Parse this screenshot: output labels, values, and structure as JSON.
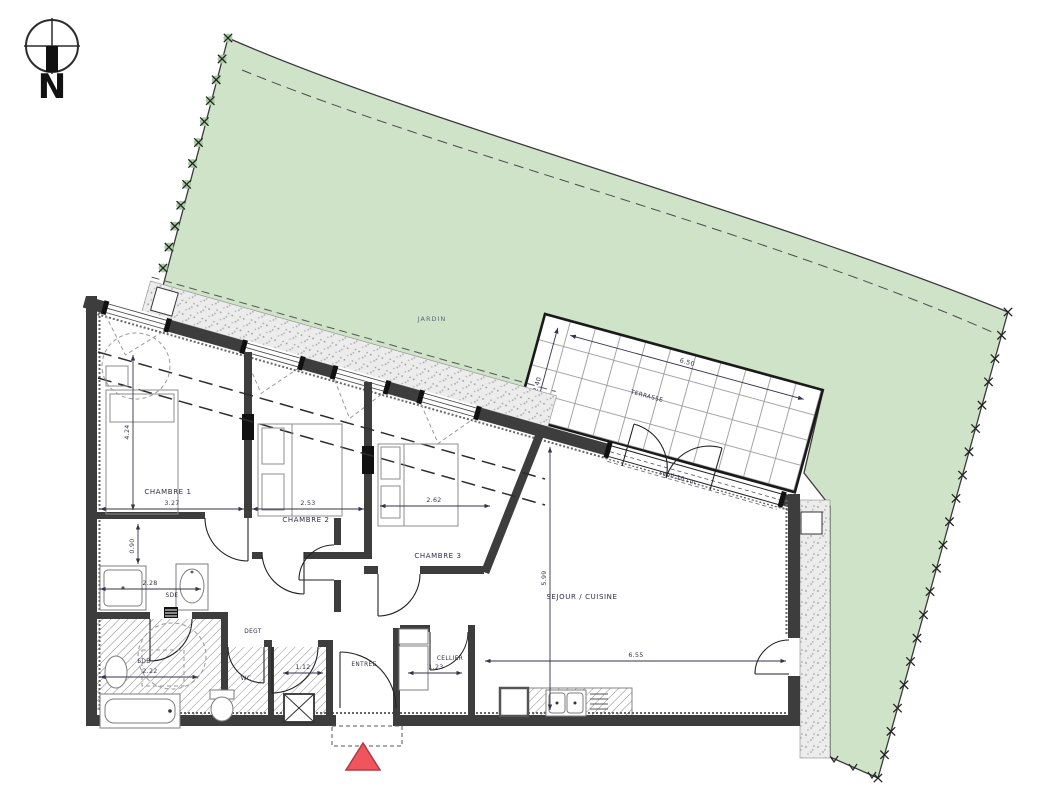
{
  "compass": {
    "north_label": "N"
  },
  "garden": {
    "label": "JARDIN"
  },
  "terrace": {
    "label": "TERRASSE",
    "width_m": "6.50",
    "depth_m": "2.40",
    "threshold_note": "seuil 10 cm"
  },
  "rooms": {
    "chambre1": {
      "label": "CHAMBRE 1",
      "width_m": "3.27",
      "depth_m": "4.24"
    },
    "chambre2": {
      "label": "CHAMBRE 2",
      "width_m": "2.53"
    },
    "chambre3": {
      "label": "CHAMBRE 3",
      "width_m": "2.62"
    },
    "sejour": {
      "label": "SEJOUR / CUISINE",
      "width_m": "6.55",
      "depth_m": "5.99"
    },
    "sde": {
      "label": "SDE",
      "width_m": "2.28",
      "door_m": "0.90"
    },
    "sdb": {
      "label": "SDB",
      "width_m": "2.22"
    },
    "degagement": {
      "label": "DEGT"
    },
    "wc": {
      "label": "WC",
      "width_m": "1.12"
    },
    "entree": {
      "label": "ENTREE"
    },
    "cellier": {
      "label": "CELLIER",
      "width_m": "1.23"
    }
  },
  "colors": {
    "garden_fill": "#cfe3c9",
    "wall": "#3d3d3d",
    "entrance_marker": "#f0545c",
    "terrace_grid": "#9a9a9a"
  }
}
